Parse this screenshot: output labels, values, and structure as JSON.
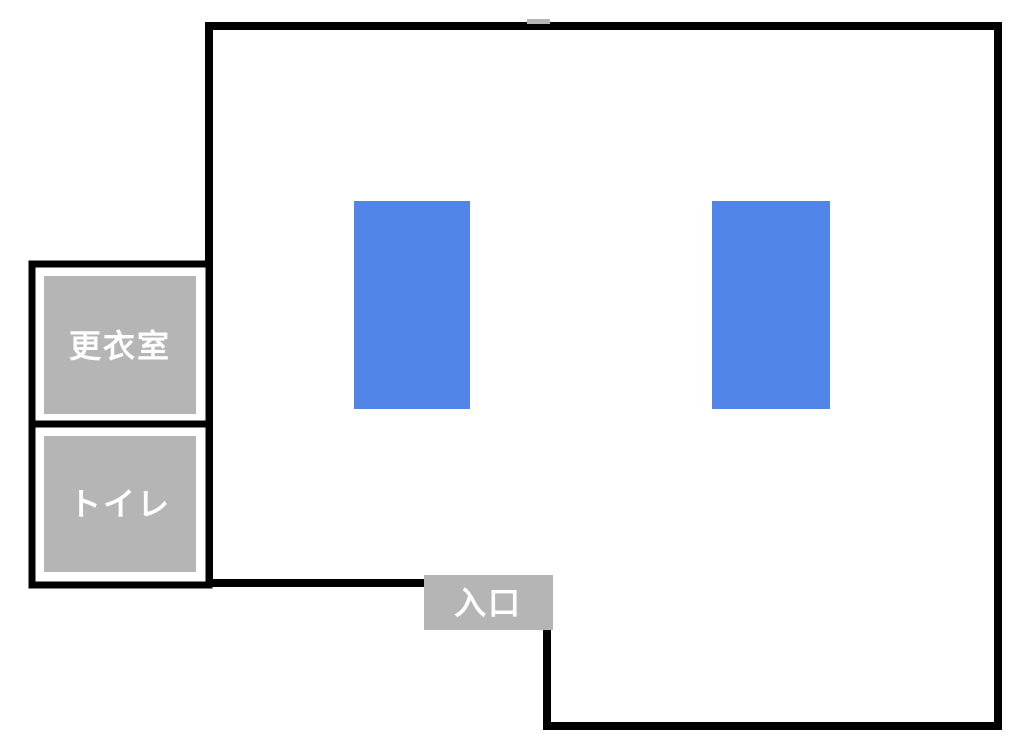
{
  "floor_plan": {
    "title": "gym-floor-plan",
    "colors": {
      "background": "#ffffff",
      "wall": "#000000",
      "area_gray": "#b5b5b5",
      "mat_blue": "#5285e8",
      "label_text": "#ffffff"
    },
    "rooms": [
      {
        "id": "changing-room",
        "label": "更衣室"
      },
      {
        "id": "toilet",
        "label": "トイレ"
      }
    ],
    "entrance": {
      "label": "入口"
    },
    "mats": [
      {
        "id": "blue-area-left"
      },
      {
        "id": "blue-area-right"
      }
    ]
  }
}
